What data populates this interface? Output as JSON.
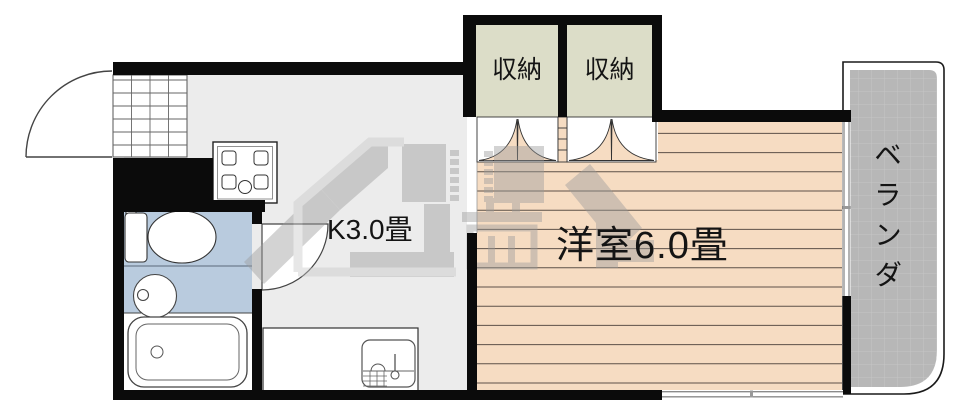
{
  "labels": {
    "closet_left": "収納",
    "closet_right": "収納",
    "kitchen": "K3.0畳",
    "western_room": "洋室6.0畳",
    "veranda": "ベランダ"
  },
  "colors": {
    "wall": "#0b0b0b",
    "wood_floor": "#f6dcc2",
    "wood_floor_line": "#5d5148",
    "kitchen_floor": "#ececec",
    "closet_fill": "#dcddc8",
    "bathroom_fill": "#b9cbde",
    "veranda_fill": "#b7b7b7",
    "veranda_grid": "#c6c6c6",
    "watermark_gray": "#9b9b9b",
    "watermark_light": "#c8c8c8"
  },
  "fixtures": [
    "entrance-door",
    "genkan-tile-grid",
    "gas-stove",
    "kitchen-counter-sink",
    "toilet",
    "wash-basin",
    "bathtub",
    "bathroom-door",
    "closet-folding-doors",
    "sliding-glass-door",
    "window"
  ]
}
